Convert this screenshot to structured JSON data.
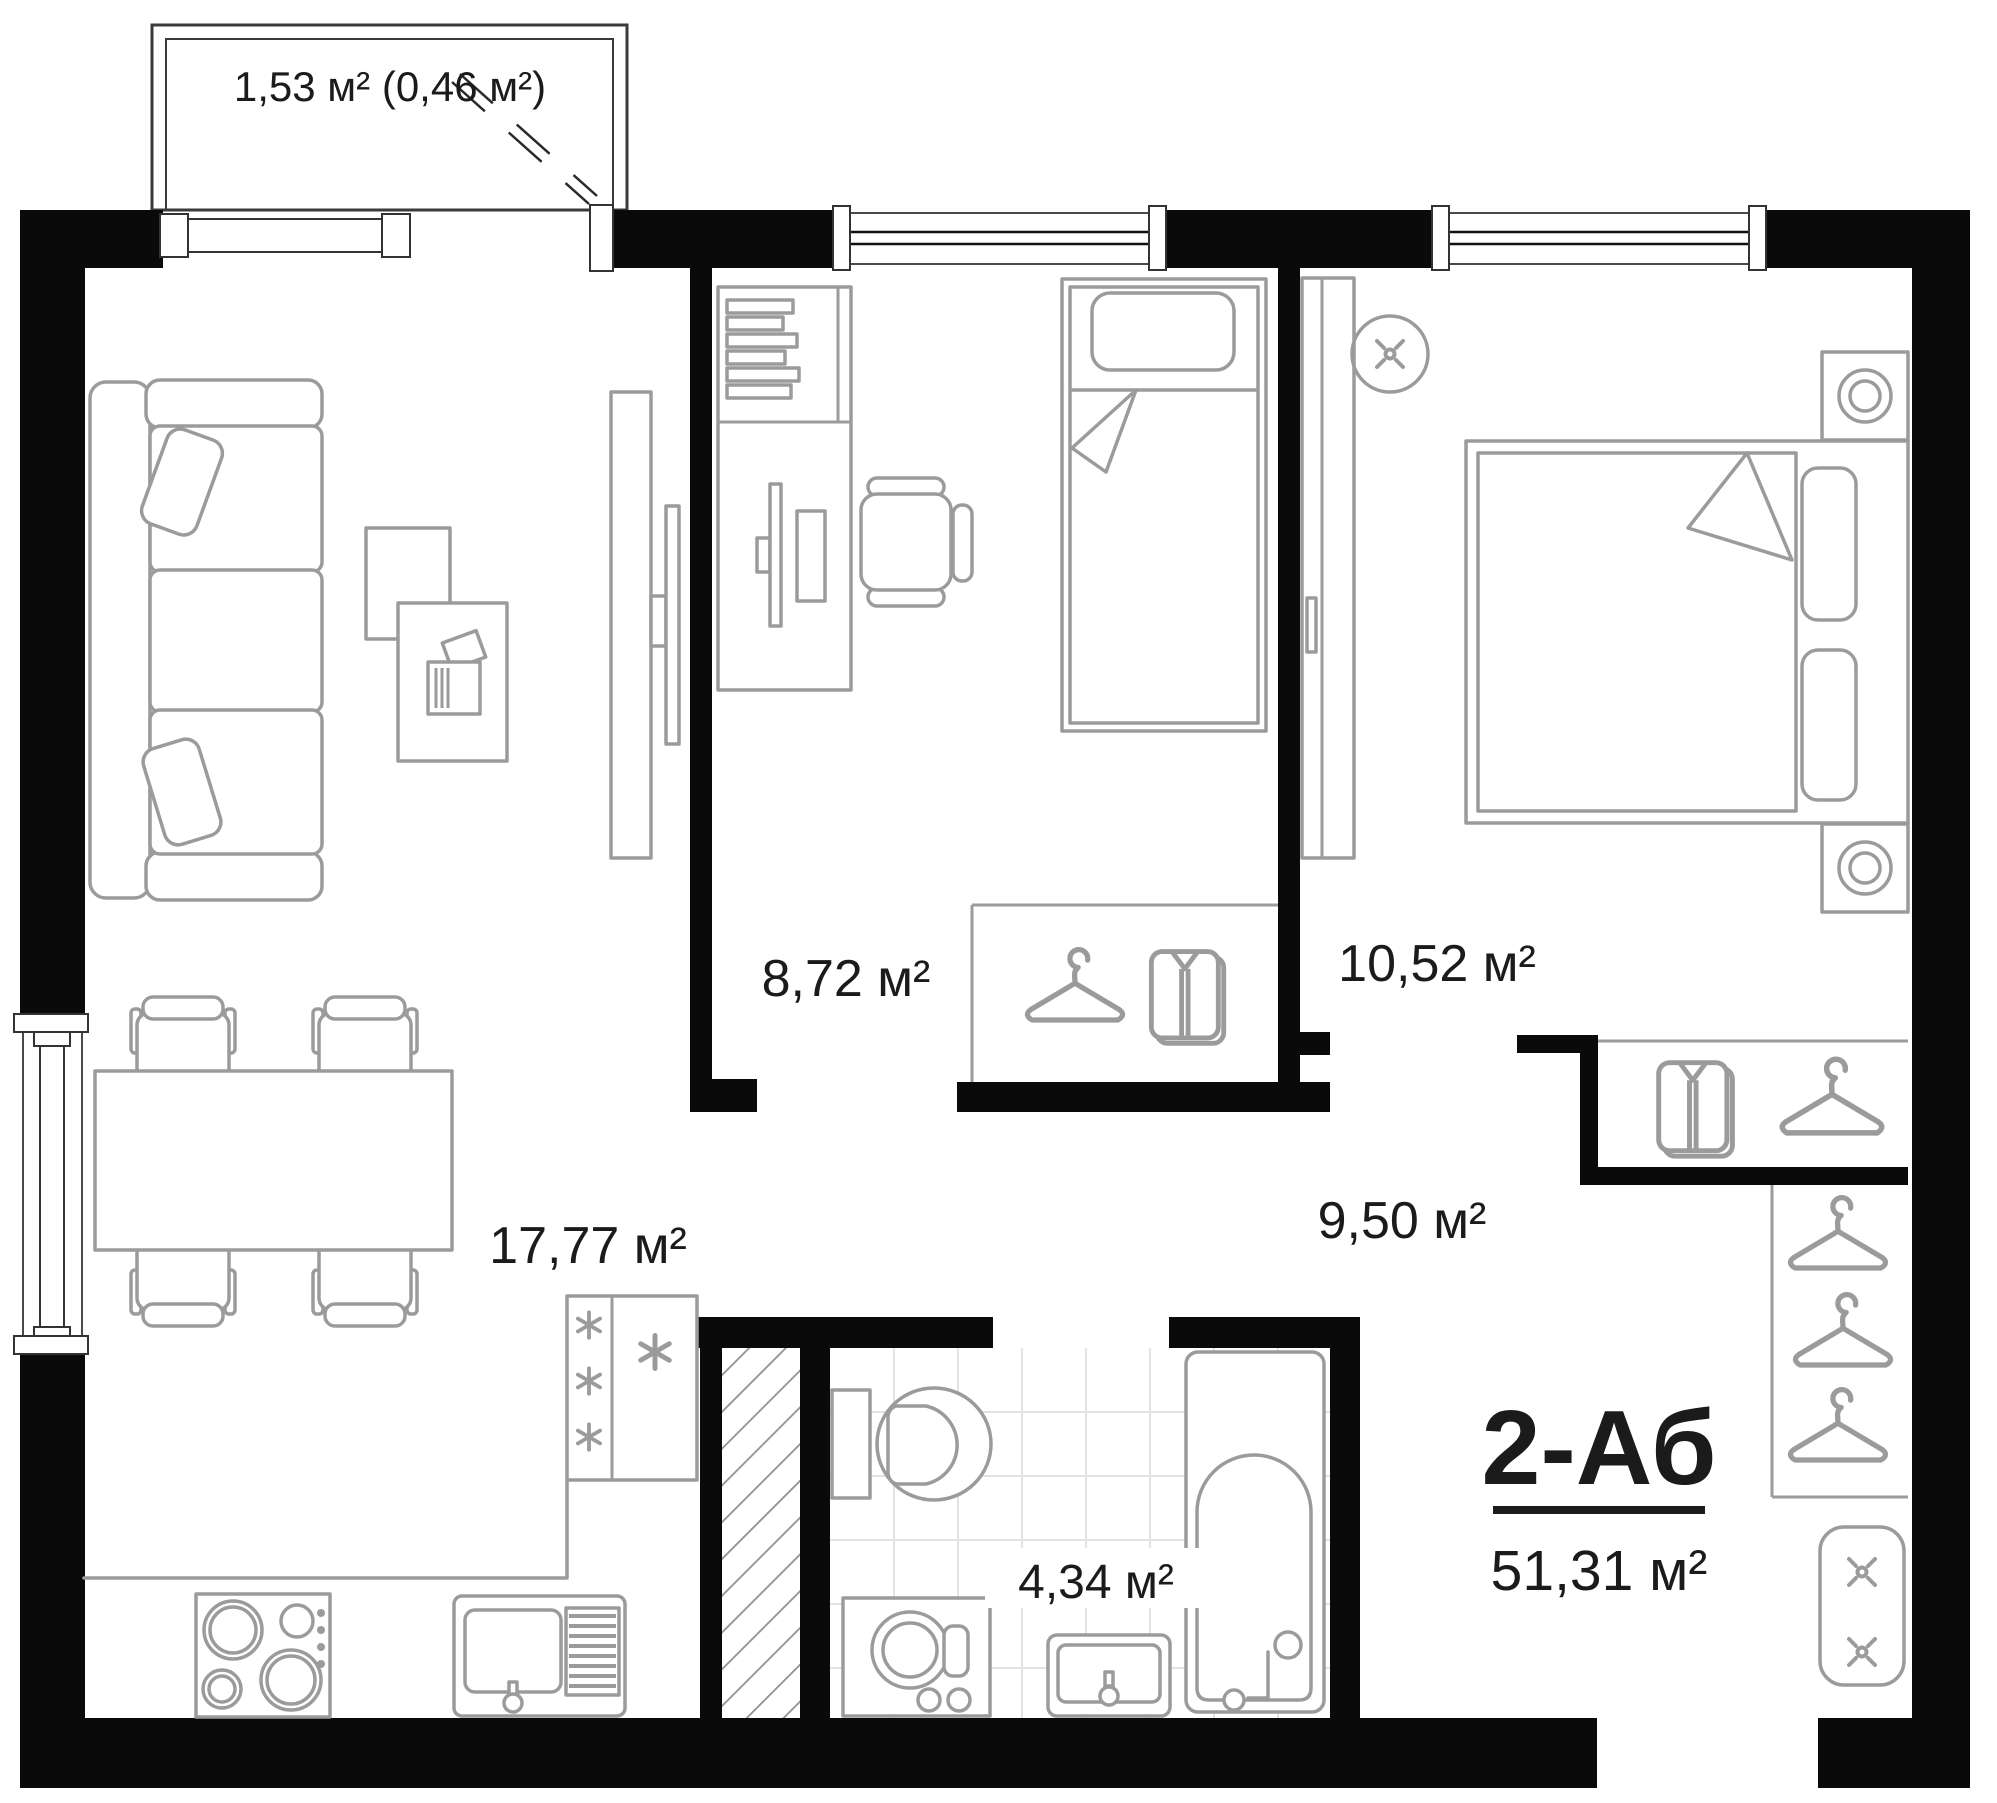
{
  "plan": {
    "labels": {
      "balcony": "1,53 м² (0,46 м²)",
      "bedroom": "8,72 м²",
      "master_bedroom": "10,52 м²",
      "living_kitchen": "17,77 м²",
      "hallway": "9,50 м²",
      "bathroom": "4,34 м²",
      "unit_title": "2-Аб",
      "total_area": "51,31 м²"
    },
    "colors": {
      "wall": "#0a0a0a",
      "furniture": "#9b9b9b",
      "tile": "#e3e3e3",
      "text": "#1b1b1b"
    }
  }
}
